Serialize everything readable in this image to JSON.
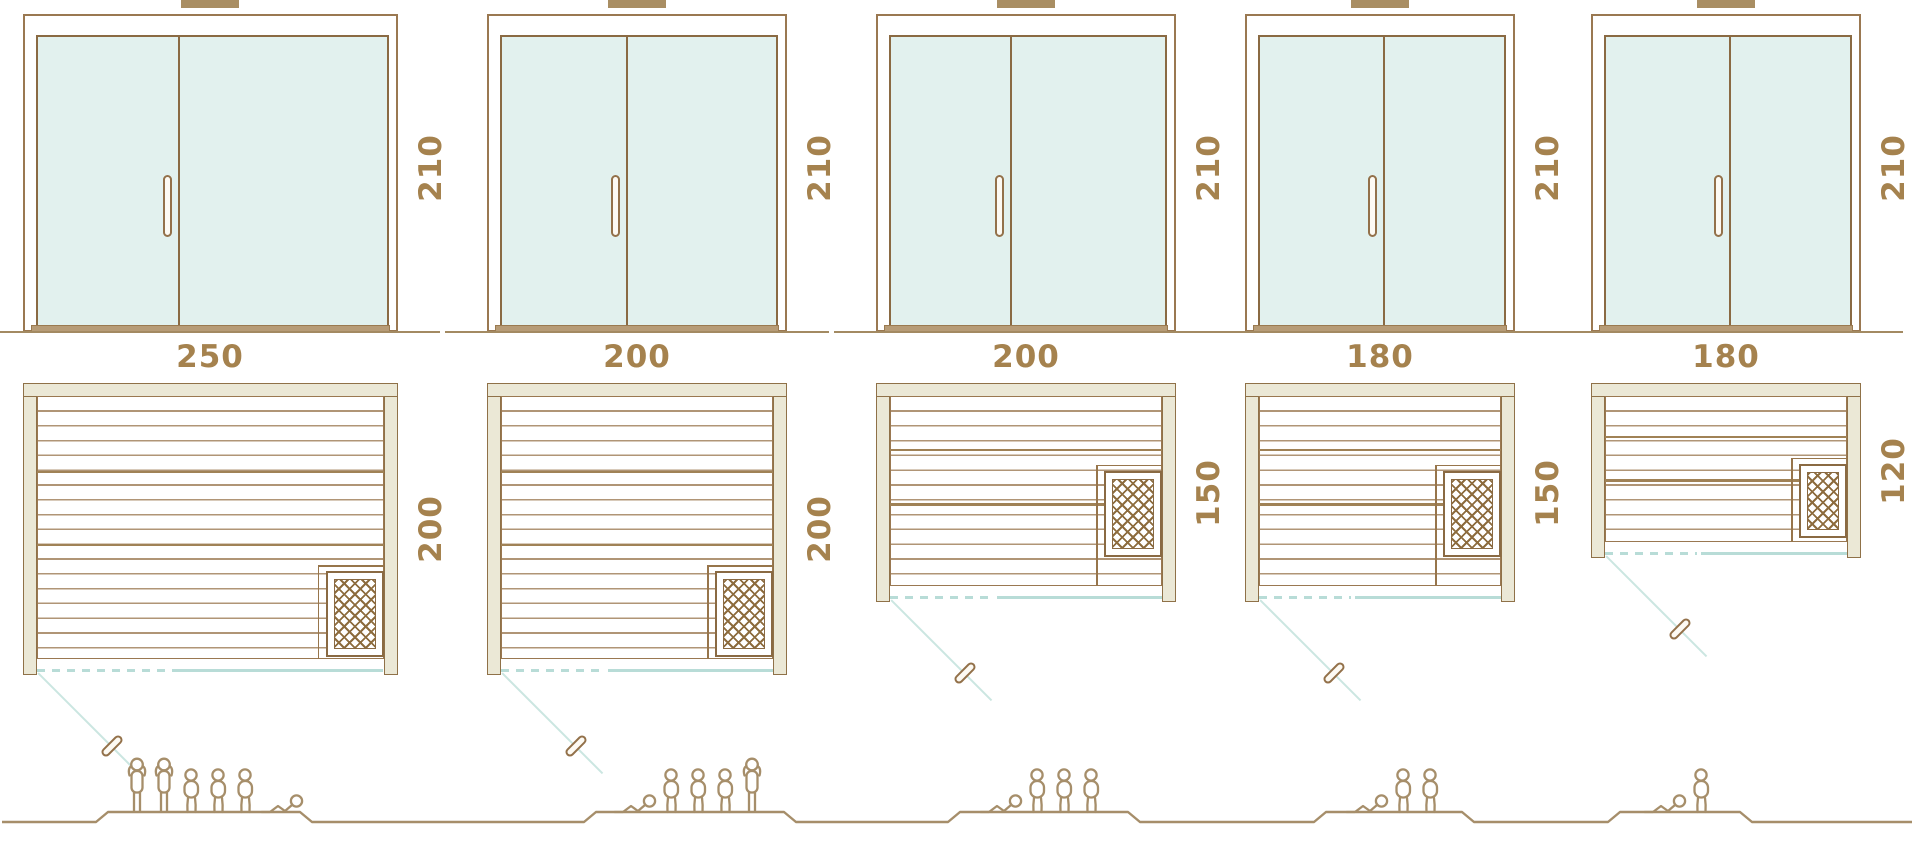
{
  "saunas": [
    {
      "width": "250",
      "depth": "200",
      "height": "210",
      "capacity": 6,
      "figures": [
        "standing",
        "standing",
        "seated",
        "seated",
        "seated",
        "reclining"
      ]
    },
    {
      "width": "200",
      "depth": "200",
      "height": "210",
      "capacity": 5,
      "figures": [
        "reclining",
        "seated",
        "seated",
        "seated",
        "standing"
      ]
    },
    {
      "width": "200",
      "depth": "150",
      "height": "210",
      "capacity": 4,
      "figures": [
        "reclining",
        "seated",
        "seated",
        "seated"
      ]
    },
    {
      "width": "180",
      "depth": "150",
      "height": "210",
      "capacity": 3,
      "figures": [
        "reclining",
        "seated",
        "seated"
      ]
    },
    {
      "width": "180",
      "depth": "120",
      "height": "210",
      "capacity": 2,
      "figures": [
        "reclining",
        "seated"
      ]
    }
  ],
  "colors": {
    "wood_outline": "#9a7851",
    "beige_fill": "#ebe8d6",
    "glass_fill": "#e2f1ee",
    "teal_line": "#b8dcd7",
    "dimension_text": "#a5824e",
    "figure_outline": "#a68e6a"
  }
}
